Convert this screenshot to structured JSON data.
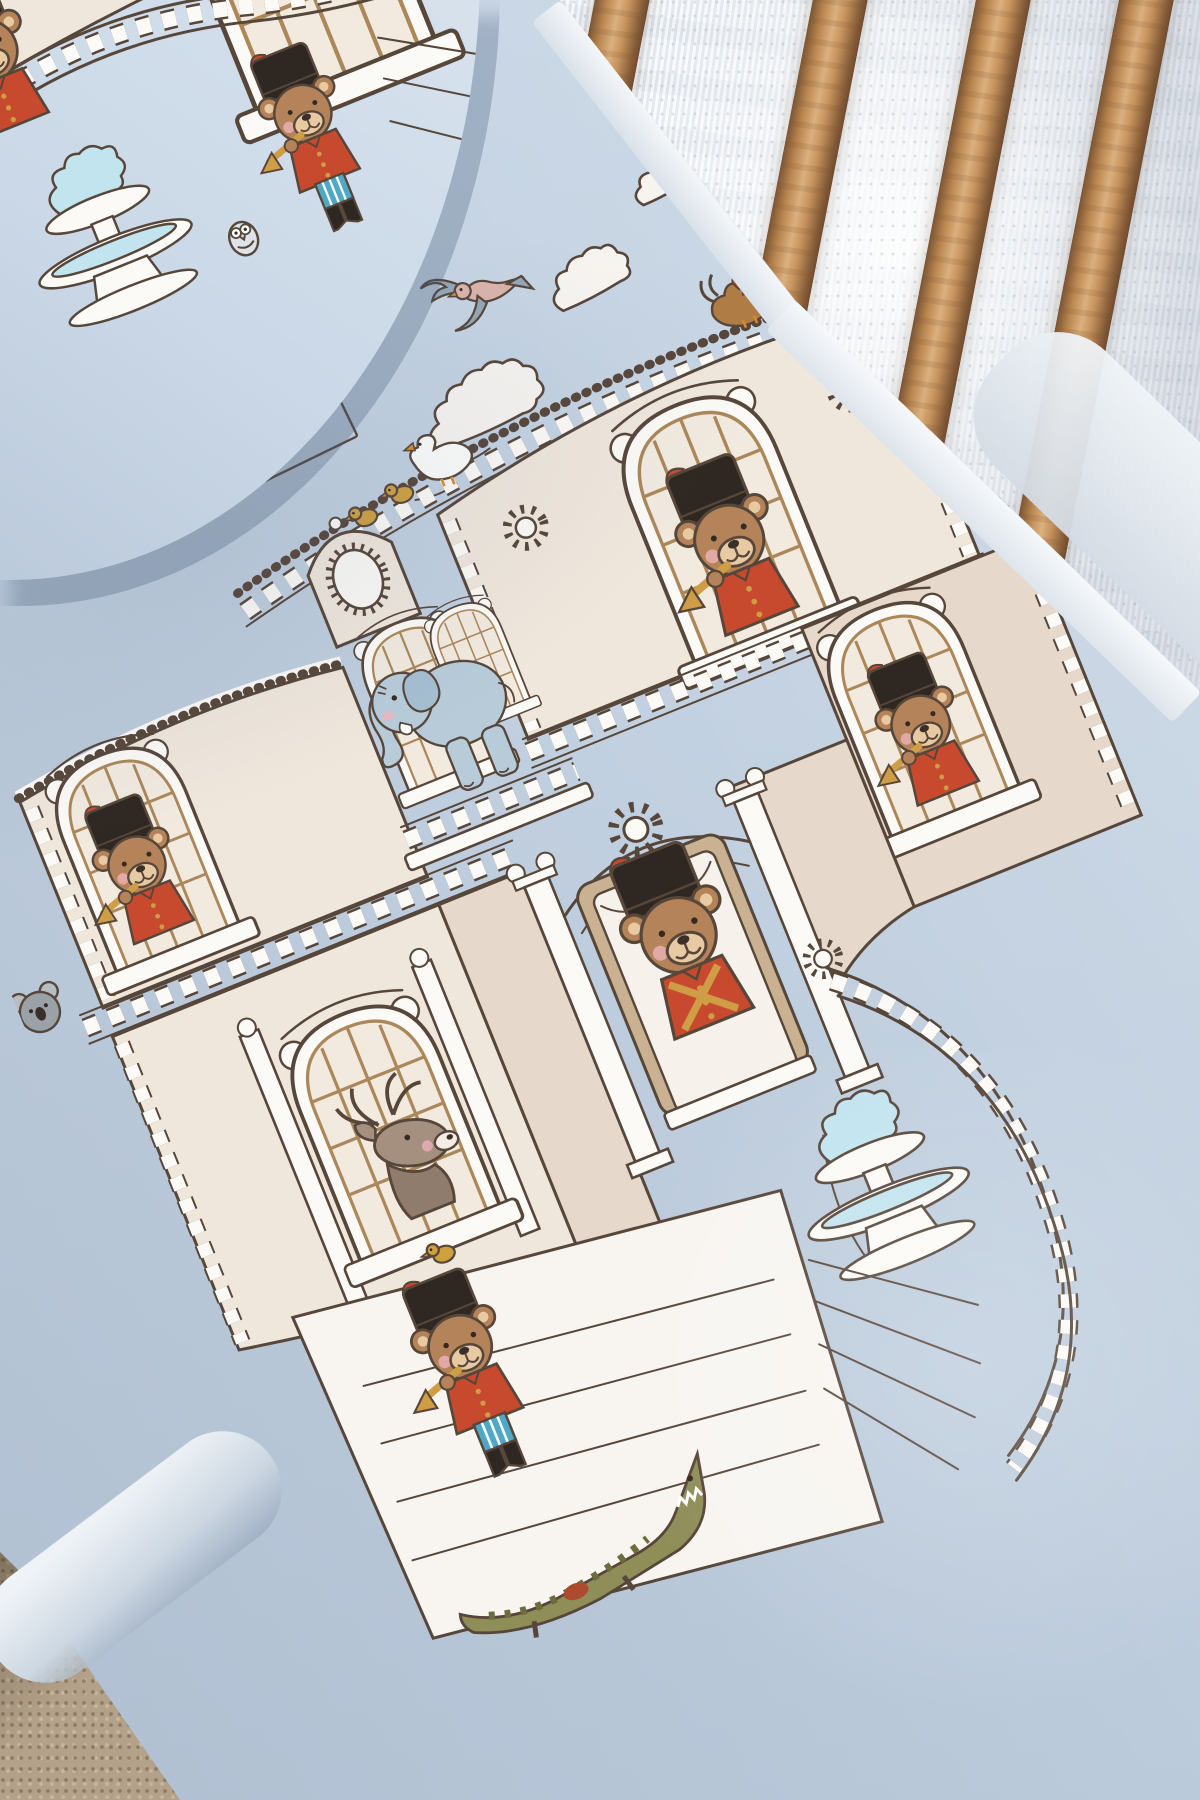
{
  "scene": {
    "setting": "baby crib corner in soft daylight",
    "objects": [
      "printed fitted crib sheet",
      "matching print pillow",
      "wooden crib rail spindles",
      "sheer lace curtain",
      "beige carpet floor"
    ]
  },
  "brand_stamp": {
    "title": "ATELIER BABBI",
    "subtitle": "SWEET DREAMS"
  },
  "print": {
    "theme": "hand-drawn royal palace populated by toy-soldier teddy bears and animals",
    "characters": [
      "teddy-bear guard bugler in domed top window",
      "teddy-bear guard bugler in left wing window",
      "teddy-bear guard in right wing window",
      "drum-major teddy bear at grand entrance",
      "standing teddy-bear bugler on plaza steps",
      "blue elephant on balcony",
      "deer in arched window",
      "white goose on roofline",
      "golden ducklings",
      "rooster on right roofline",
      "flying pigeons",
      "owl on staircase newel",
      "koala peeking at left edge",
      "crocodile on bottom steps",
      "bluebird on right wall",
      "chick at deer window sill"
    ],
    "architecture": [
      "scalloped clouds",
      "domed pavilion with rosette medallions",
      "arched lattice windows",
      "balustrades with turned posts",
      "clock gable",
      "grand entrance with scroll columns",
      "sweeping staircase balustrade",
      "double-basin fountain with splashing water",
      "stone plaza steps"
    ]
  },
  "colors": {
    "sheet": "#c4d3e3",
    "pillowfab": "#cad8e7",
    "curtain": "#eef1f4",
    "wood": "#c49a6c",
    "carpet": "#b3a189",
    "ink": "#57463a",
    "wall": "#f0e7dc",
    "wallsh": "#e6d8ca",
    "trim": "#fcfaf6",
    "wood2": "#ab8759",
    "fur": "#b5835a",
    "muzzle": "#e7c9a2",
    "hat": "#2f2721",
    "red": "#c84a2e",
    "gold": "#cf9d45",
    "blue": "#4fa8c6",
    "water": "#c2e4ef",
    "duck": "#cfa040",
    "orange": "#d98a2b",
    "slate": "#93a7b8",
    "deer": "#a59080",
    "ele": "#b7cbd9",
    "croc": "#8f8d58",
    "pink": "#f0b4bf"
  }
}
